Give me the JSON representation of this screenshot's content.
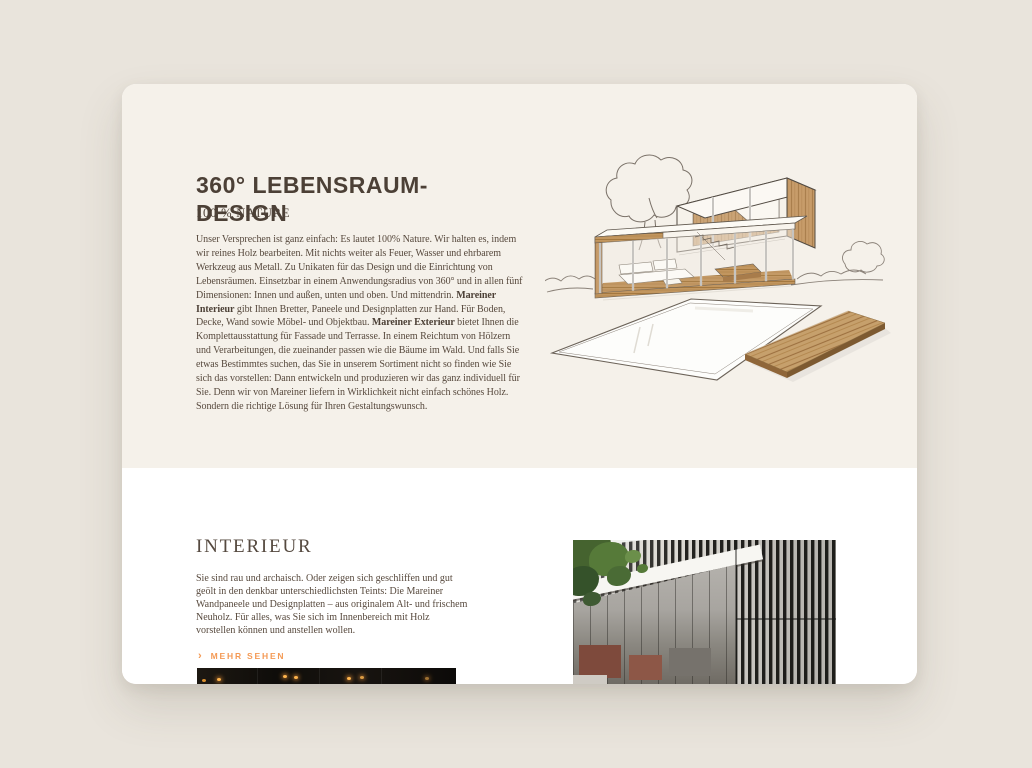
{
  "page": {
    "background": "#e9e4dc"
  },
  "colors": {
    "card_top_bg": "#f5f1ea",
    "card_bottom_bg": "#ffffff",
    "heading_text": "#4c4036",
    "body_text": "#57493d",
    "accent_orange": "#f49a55",
    "wood": "#c49b6b"
  },
  "hero": {
    "title_line1": "360° LEBENSRAUM-",
    "title_line2": "DESIGN",
    "subtitle": "100 % NATURE",
    "paragraph": {
      "s0": "Unser Versprechen ist ganz einfach: Es lautet 100% Nature. Wir halten es, indem wir reines Holz bearbeiten. Mit nichts weiter als Feuer, Wasser und ehrbarem Werkzeug aus Metall. Zu Unikaten für das Design und die Einrichtung von Lebensräumen. Einsetzbar in einem Anwendungsradius von 360° und in allen fünf Dimensionen: Innen und außen, unten und oben. Und mittendrin. ",
      "s1": "Mareiner Interieur",
      "s2": " gibt Ihnen Bretter, Paneele und Designplatten zur Hand. Für Boden, Decke, Wand sowie Möbel- und Objektbau. ",
      "s3": "Mareiner Exterieur",
      "s4": " bietet Ihnen die Komplettausstattung für Fassade und Terrasse. In einem Reichtum von Hölzern und Verarbeitungen, die zueinander passen wie die Bäume im Wald. Und falls Sie etwas Bestimmtes suchen, das Sie in unserem Sortiment nicht so finden wie Sie sich das vorstellen: Dann entwickeln und produzieren wir das ganz individuell für Sie. Denn wir von Mareiner liefern in Wirklichkeit nicht einfach schönes Holz. Sondern die richtige Lösung für Ihren Gestaltungswunsch."
    }
  },
  "interieur": {
    "heading": "INTERIEUR",
    "paragraph": "Sie sind rau und archaisch. Oder zeigen sich geschliffen und gut geölt in den denkbar unterschiedlichsten Teints: Die Mareiner Wandpaneele und Designplatten – aus originalem Alt- und frischem Neuholz. Für alles, was Sie sich im Innenbereich mit Holz vorstellen können und anstellen wollen.",
    "link": {
      "chevron": "›",
      "label": "MEHR SEHEN"
    }
  }
}
